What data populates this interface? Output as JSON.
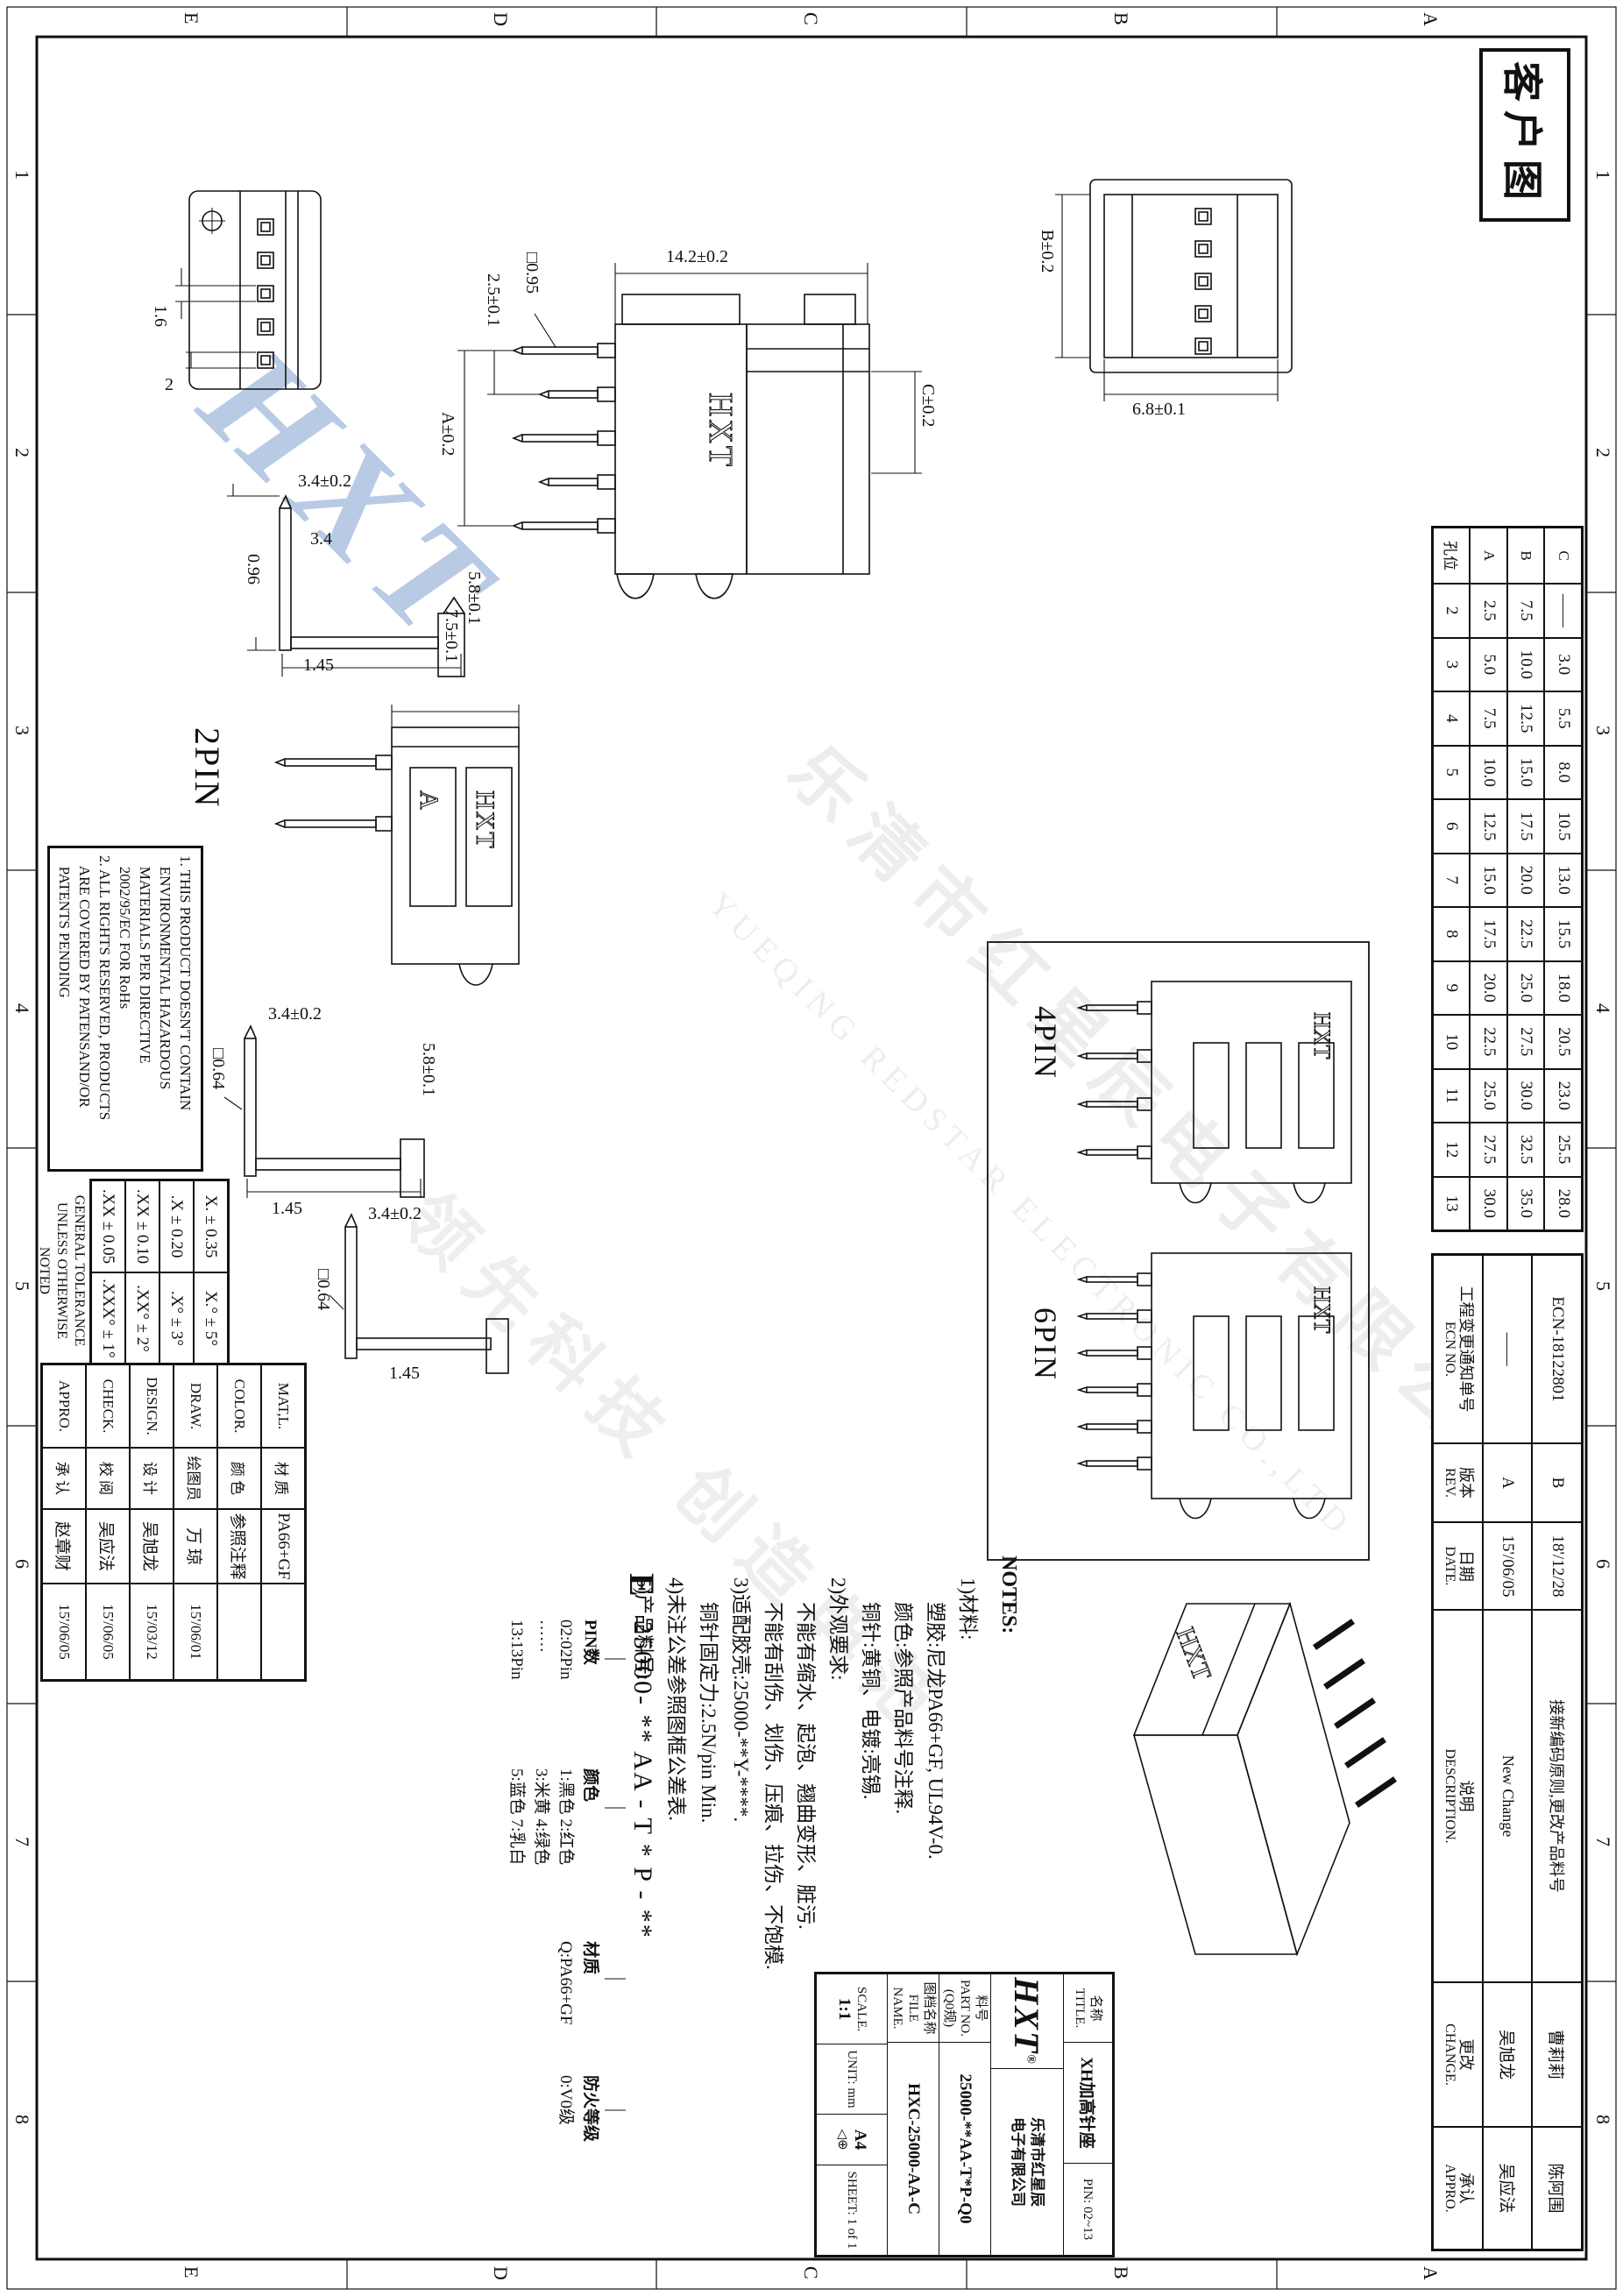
{
  "frame": {
    "stamp": "客户图",
    "zone_letters": [
      "A",
      "B",
      "C",
      "D",
      "E"
    ],
    "zone_numbers": [
      "1",
      "2",
      "3",
      "4",
      "5",
      "6",
      "7",
      "8"
    ]
  },
  "chart_data": {
    "type": "table",
    "title": "孔位尺寸表",
    "columns": [
      "孔位",
      "A",
      "B",
      "C"
    ],
    "rows": [
      [
        2,
        2.5,
        7.5,
        null
      ],
      [
        3,
        5.0,
        10.0,
        3.0
      ],
      [
        4,
        7.5,
        12.5,
        5.5
      ],
      [
        5,
        10.0,
        15.0,
        8.0
      ],
      [
        6,
        12.5,
        17.5,
        10.5
      ],
      [
        7,
        15.0,
        20.0,
        13.0
      ],
      [
        8,
        17.5,
        22.5,
        15.5
      ],
      [
        9,
        20.0,
        25.0,
        18.0
      ],
      [
        10,
        22.5,
        27.5,
        20.5
      ],
      [
        11,
        25.0,
        30.0,
        23.0
      ],
      [
        12,
        27.5,
        32.5,
        25.5
      ],
      [
        13,
        30.0,
        35.0,
        28.0
      ]
    ]
  },
  "pin_table": {
    "rows": [
      {
        "cells": [
          "C",
          "——",
          "3.0",
          "5.5",
          "8.0",
          "10.5",
          "13.0",
          "15.5",
          "18.0",
          "20.5",
          "23.0",
          "25.5",
          "28.0"
        ]
      },
      {
        "cells": [
          "B",
          "7.5",
          "10.0",
          "12.5",
          "15.0",
          "17.5",
          "20.0",
          "22.5",
          "25.0",
          "27.5",
          "30.0",
          "32.5",
          "35.0"
        ]
      },
      {
        "cells": [
          "A",
          "2.5",
          "5.0",
          "7.5",
          "10.0",
          "12.5",
          "15.0",
          "17.5",
          "20.0",
          "22.5",
          "25.0",
          "27.5",
          "30.0"
        ]
      },
      {
        "cells": [
          "孔位",
          "2",
          "3",
          "4",
          "5",
          "6",
          "7",
          "8",
          "9",
          "10",
          "11",
          "12",
          "13"
        ]
      }
    ]
  },
  "ecn_table": {
    "headers": [
      {
        "zh": "工程变更通知单号",
        "en": "ECN NO."
      },
      {
        "zh": "版本",
        "en": "REV."
      },
      {
        "zh": "日期",
        "en": "DATE."
      },
      {
        "zh": "说明",
        "en": "DESCRIPTION."
      },
      {
        "zh": "更改",
        "en": "CHANGE."
      },
      {
        "zh": "承认",
        "en": "APPRO."
      }
    ],
    "rows": [
      {
        "cells": [
          "ECN-18122801",
          "B",
          "18'/12/28",
          "接新编码原则,更改产品料号",
          "曹莉莉",
          "陈阿围"
        ]
      },
      {
        "cells": [
          "——",
          "A",
          "15'/06/05",
          "New Change",
          "吴旭龙",
          "吴应法"
        ]
      }
    ]
  },
  "views": {
    "brand": "HXT",
    "slot_letter": "A",
    "back": {
      "dims": {
        "b": "B±0.2",
        "d68": "6.8±0.1"
      }
    },
    "section": {
      "dims": {
        "w": "14.2±0.2",
        "c": "C±0.2",
        "sq": "□0.95",
        "pitch": "2.5±0.1",
        "a": "A±0.2"
      }
    },
    "front": {
      "dims": {
        "h": "1.6",
        "p": "2"
      }
    },
    "profile1": {
      "dims": {
        "h58": "5.8±0.1",
        "v34t": "3.4±0.2",
        "v34": "3.4",
        "d096": "0.96",
        "d145": "1.45"
      }
    },
    "pin2": {
      "label": "2PIN",
      "dims": {
        "h75": "7.5±0.1"
      }
    },
    "profile2": {
      "dims": {
        "h58": "5.8±0.1",
        "v34t": "3.4±0.2",
        "sq": "□0.64",
        "d145": "1.45"
      }
    },
    "profile3": {
      "dims": {
        "v34t": "3.4±0.2",
        "sq": "□0.64",
        "d145": "1.45"
      }
    },
    "pin4": {
      "label": "4PIN"
    },
    "pin6": {
      "label": "6PIN"
    }
  },
  "notes": {
    "title": "NOTES:",
    "lines": [
      {
        "t": "1)材料:",
        "i": 0
      },
      {
        "t": "塑胶:尼龙PA66+GF, UL94V-0.",
        "i": 1
      },
      {
        "t": "颜色:参照产品料号注释.",
        "i": 1
      },
      {
        "t": "铜针:黄铜、电镀:亮锡.",
        "i": 1
      },
      {
        "t": "2)外观要求:",
        "i": 0
      },
      {
        "t": "不能有缩水、起泡、翘曲变形、脏污.",
        "i": 1
      },
      {
        "t": "不能有刮伤、划伤、压痕、拉伤、不饱模.",
        "i": 1
      },
      {
        "t": "3)适配胶壳:25000-**Y-****.",
        "i": 0
      },
      {
        "t": "铜针固定力:2.5N/pin Min.",
        "i": 1
      },
      {
        "t": "4)未注公差参照图框公差表.",
        "i": 0
      },
      {
        "t": "5)产品料号:",
        "i": 0
      }
    ],
    "part_number_line": "25000- ** AA - T * P - **",
    "zone_mark": "E",
    "legends": [
      {
        "title": "PIN数",
        "items": [
          "02:02Pin",
          "······",
          "13:13Pin"
        ]
      },
      {
        "title": "颜色",
        "items": [
          "1:黑色 2:红色",
          "3:米黄 4:绿色",
          "5:蓝色 7:乳白"
        ]
      },
      {
        "title": "材质",
        "items": [
          "Q:PA66+GF"
        ]
      },
      {
        "title": "防火等级",
        "items": [
          "0:V0级"
        ]
      }
    ]
  },
  "disclaimer": {
    "lines": [
      "1. THIS PRODUCT DOESN'T CONTAIN",
      "   ENVIRONMENTAL HAZARDOUS",
      "   MATERIALS PER DIRECTIVE",
      "   2002/95/EC FOR RoHs",
      "2. ALL RIGHTS RESERVED, PRODUCTS",
      "   ARE COVERED BY PATENSAND/OR",
      "   PATENTS PENDING"
    ]
  },
  "tolerance": {
    "rows": [
      {
        "linear": "X. ± 0.35",
        "angular": "X.° ± 5°"
      },
      {
        "linear": ".X ± 0.20",
        "angular": ".X° ± 3°"
      },
      {
        "linear": ".XX ± 0.10",
        "angular": ".XX° ± 2°"
      },
      {
        "linear": ".XX ± 0.05",
        "angular": ".XXX° ± 1°"
      }
    ],
    "note1": "GENERAL TOLERANCE",
    "note2": "UNLESS OTHERWISE NOTED"
  },
  "titleblock": {
    "rows": [
      {
        "en": "MAT,L.",
        "zh": "材 质",
        "value": "PA66+GF",
        "date": ""
      },
      {
        "en": "COLOR.",
        "zh": "颜 色",
        "value": "参照注释",
        "date": ""
      },
      {
        "en": "DRAW.",
        "zh": "绘图员",
        "value": "万 琼",
        "date": "15'/06/01"
      },
      {
        "en": "DESIGN.",
        "zh": "设 计",
        "value": "吴旭龙",
        "date": "15'/03/12"
      },
      {
        "en": "CHECK.",
        "zh": "校 阅",
        "value": "吴应法",
        "date": "15'/06/05"
      },
      {
        "en": "APPRO.",
        "zh": "承 认",
        "value": "赵章财",
        "date": "15'/06/05"
      }
    ]
  },
  "infoblock": {
    "title_label_zh": "名称",
    "title_label_en": "TITLE.",
    "title_value": "XH加高针座",
    "pin_range": "PIN: 02~13",
    "logo": "HXT",
    "logo_reg": "®",
    "company_line1": "乐清市红星辰",
    "company_line2": "电子有限公司",
    "part_label_zh": "料号",
    "part_label_en": "PART NO.",
    "part_spec": "(Q0规)",
    "part_value": "25000-**AA-T*P-Q0",
    "file_label_zh": "图档名称",
    "file_label_en": "FILE NAME.",
    "file_value": "HXC-25000-AA-C",
    "scale_label": "SCALE.",
    "scale_value": "1:1",
    "unit_label": "UNIT: mm",
    "paper": "A4",
    "projection": "◁⊕",
    "sheet_label": "SHEET: 1 of 1"
  },
  "watermark": {
    "hxt": "HXT",
    "cn1": "乐清市红星辰电子有限公司",
    "en": "YUEQING REDSTAR ELECTRONIC CO.,LTD",
    "cn2": "领先科技 创造典范",
    "blue": "#648cc3"
  }
}
